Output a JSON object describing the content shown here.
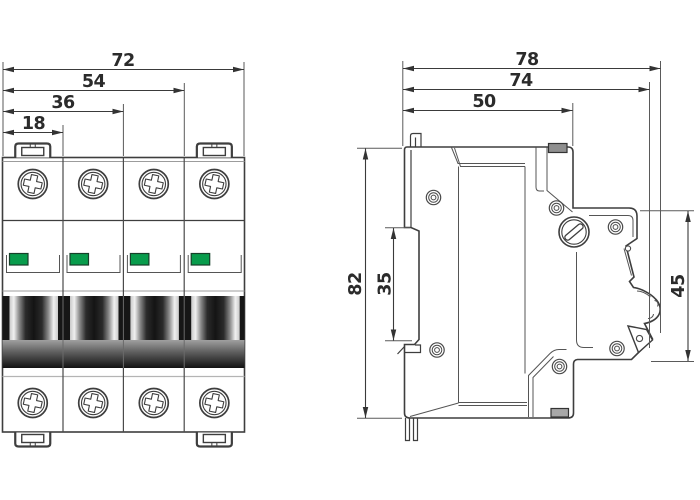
{
  "drawing_type": "dimensioned technical drawing, 4-pole miniature circuit breaker",
  "front_view": {
    "pole_count": 4,
    "dims": [
      {
        "name": "overall-width",
        "value": "72"
      },
      {
        "name": "three-pole-width",
        "value": "54"
      },
      {
        "name": "two-pole-width",
        "value": "36"
      },
      {
        "name": "single-pole-width",
        "value": "18"
      }
    ]
  },
  "side_view": {
    "dims_h": [
      {
        "name": "overall-depth",
        "value": "78"
      },
      {
        "name": "depth-to-toggle-base",
        "value": "74"
      },
      {
        "name": "body-depth",
        "value": "50"
      }
    ],
    "dims_v": [
      {
        "name": "overall-height",
        "value": "82"
      },
      {
        "name": "din-rail-recess-height",
        "value": "35"
      },
      {
        "name": "front-face-height",
        "value": "45"
      }
    ]
  },
  "colors": {
    "indicator_green": "#089c4c",
    "line": "#3e3e3e",
    "dimension_text": "#2b2b2b"
  }
}
